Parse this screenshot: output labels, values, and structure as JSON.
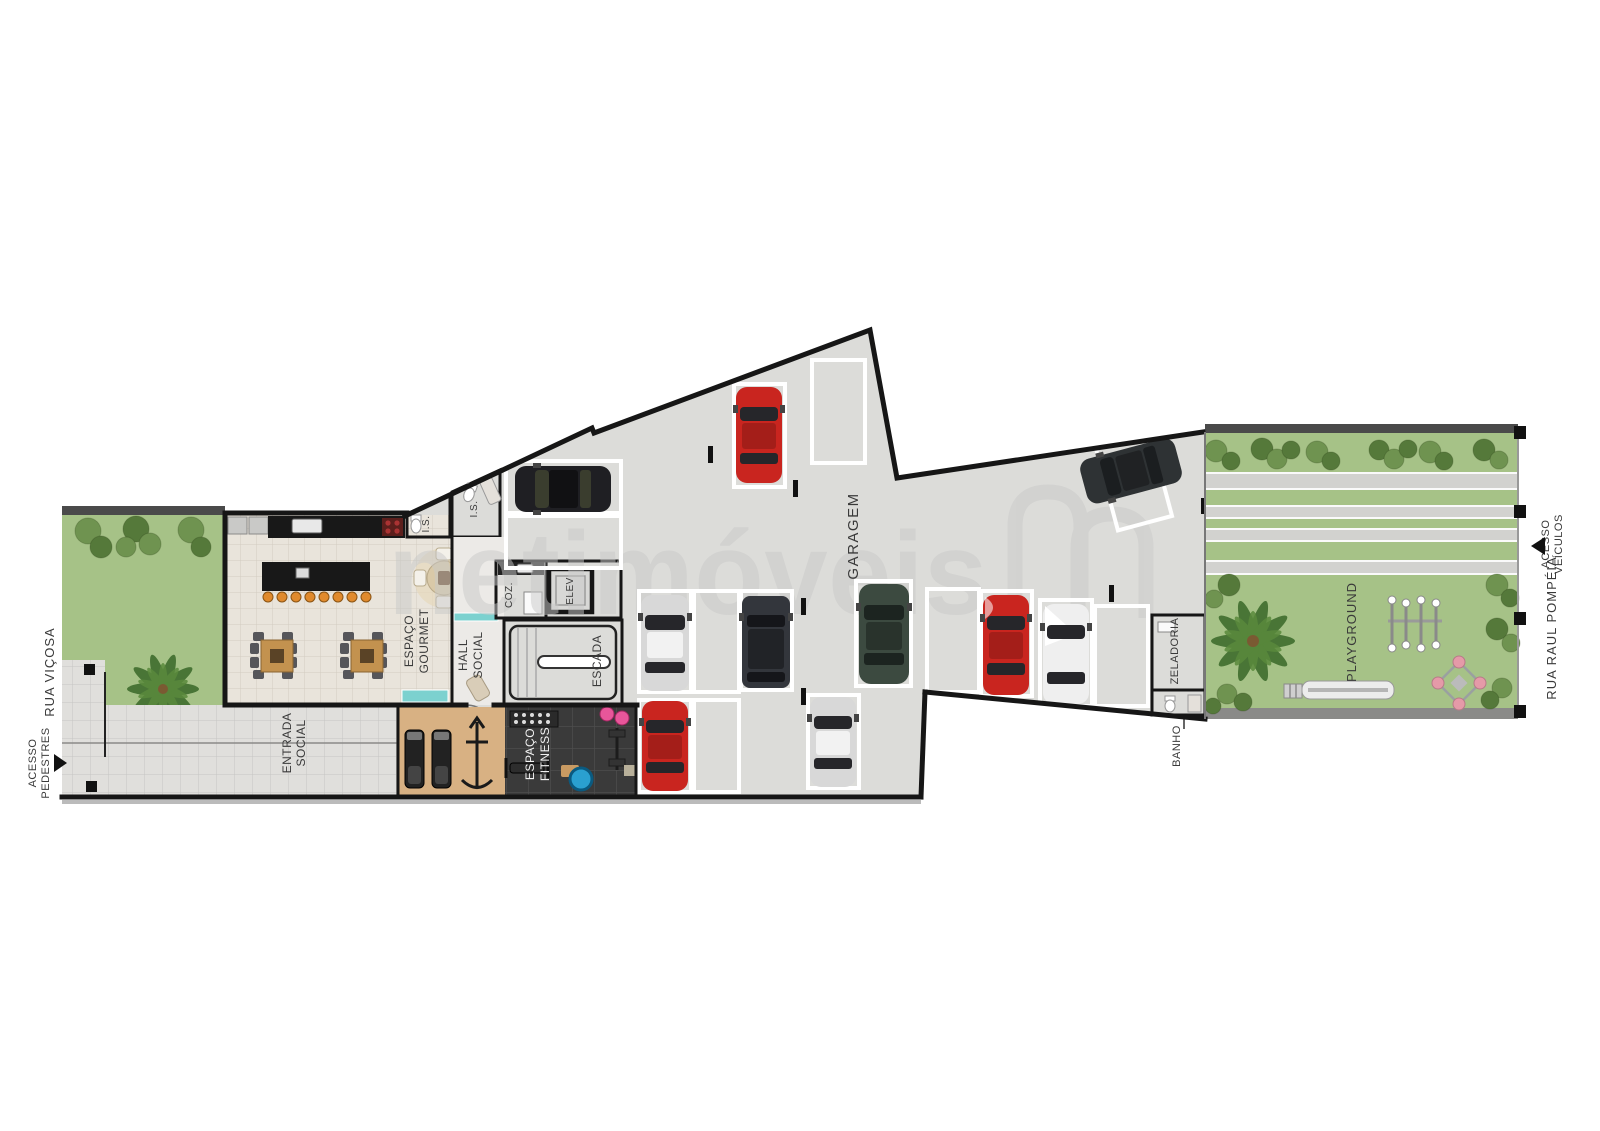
{
  "plan_title": "Pavimento térreo - implantação com garagem e áreas comuns",
  "watermark": {
    "brand": "netimóveis"
  },
  "streets": {
    "left": {
      "name": "RUA VIÇOSA",
      "access": [
        "ACESSO",
        "PEDESTRES"
      ]
    },
    "right": {
      "name": "RUA RAUL POMPÉIA",
      "access": [
        "ACESSO",
        "VEÍCULOS"
      ]
    }
  },
  "rooms": {
    "gourmet": [
      "ESPAÇO",
      "GOURMET"
    ],
    "hall": [
      "HALL",
      "SOCIAL"
    ],
    "entrada": [
      "ENTRADA",
      "SOCIAL"
    ],
    "fitness": [
      "ESPAÇO",
      "FITNESS"
    ],
    "coz": "COZ.",
    "elev": "ELEV",
    "escada": "ESCADA",
    "is1": "I.S.",
    "is2": "I.S.",
    "garagem": "GARAGEM",
    "zeladoria": "ZELADORIA",
    "banho": "BANHO",
    "playground": "PLAYGROUND"
  },
  "inventory": {
    "cars_parked": 10,
    "empty_spots": 5
  },
  "colors": {
    "wall": "#161616",
    "spot_line": "#ffffff",
    "garage_floor": "#dcdcd9",
    "gourmet_floor": "#e9e4db",
    "walkway": "#e0dfdc",
    "grass": "#a6c287",
    "watermark": "#c9c9c9",
    "car_red": "#c9251f",
    "car_silver": "#d8d8d8",
    "car_black": "#1f1f23",
    "car_suv": "#33363c",
    "car_green": "#3c4a40",
    "car_white": "#efefef",
    "car_dark": "#2e3234",
    "wood_floor": "#d8b183",
    "fitness_floor": "#3a3a3a",
    "counter": "#181818",
    "stool": "#e08a2d",
    "table_wood": "#c3924f",
    "teal": "#7cd1cf"
  }
}
